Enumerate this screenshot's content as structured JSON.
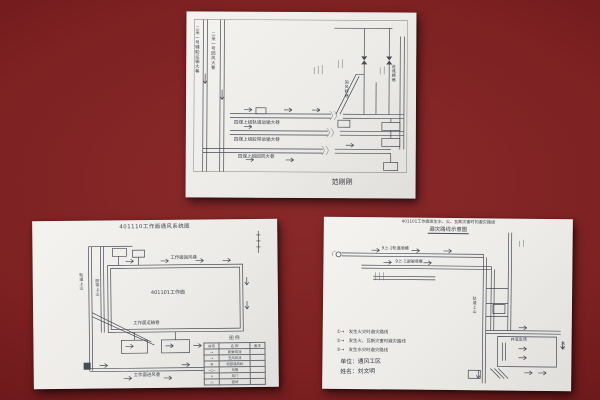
{
  "scene": {
    "background_color": "#7d2122",
    "paper_color": "#ecebe7",
    "ink_color": "#454a55"
  },
  "top_paper": {
    "labels": {
      "left_v1": "二采一号辅助运输大巷",
      "left_v2": "二采一号回风大巷",
      "road1": "四煤上组轨道运输大巷",
      "road2": "四煤上组胶带运输大巷",
      "road3": "四煤上组回风大巷",
      "incline": "回风斜巷",
      "right_shaft": "进风斜巷",
      "signature": "范刚刚"
    }
  },
  "bottom_left_paper": {
    "title": "401110工作面通风系统图",
    "labels": {
      "top_edge": "工作面回风巷",
      "face": "401101工作面",
      "inner_bottom": "工作面运输巷",
      "outer_bottom": "工作面进风巷",
      "left_v1": "轨道上山",
      "left_v2": "胶带上山"
    },
    "legend": {
      "title": "图  例",
      "headers": [
        "符号",
        "名 称",
        "备注"
      ],
      "rows": [
        {
          "sym": "→",
          "name": "新鲜风流",
          "note": ""
        },
        {
          "sym": "⇢",
          "name": "乏风风流",
          "note": ""
        },
        {
          "sym": "⊗",
          "name": "局部通风机",
          "note": ""
        },
        {
          "sym": "─○─",
          "name": "风筒",
          "note": ""
        },
        {
          "sym": "∧",
          "name": "风门",
          "note": ""
        },
        {
          "sym": "▭",
          "name": "密闭",
          "note": ""
        }
      ]
    }
  },
  "bottom_right_paper": {
    "title_line1": "401101工作面发生水、火、瓦斯灾害时的避灾路线",
    "title_line2": "避灾路线示意图",
    "labels": {
      "road1": "9上-1轨道顺槽",
      "road2": "9上-1运输顺槽",
      "trunk": "轨道上山",
      "yard": "井底车场",
      "sump": "水仓"
    },
    "legend": [
      {
        "sym": "①→",
        "text": "发生火灾时避灾路线"
      },
      {
        "sym": "②→",
        "text": "发生火、瓦斯灾害时避灾路线"
      },
      {
        "sym": "③→",
        "text": "发生水灾时避灾路线"
      }
    ],
    "footer_line1": "单位：通风工区",
    "footer_line2": "姓名：刘文明"
  }
}
